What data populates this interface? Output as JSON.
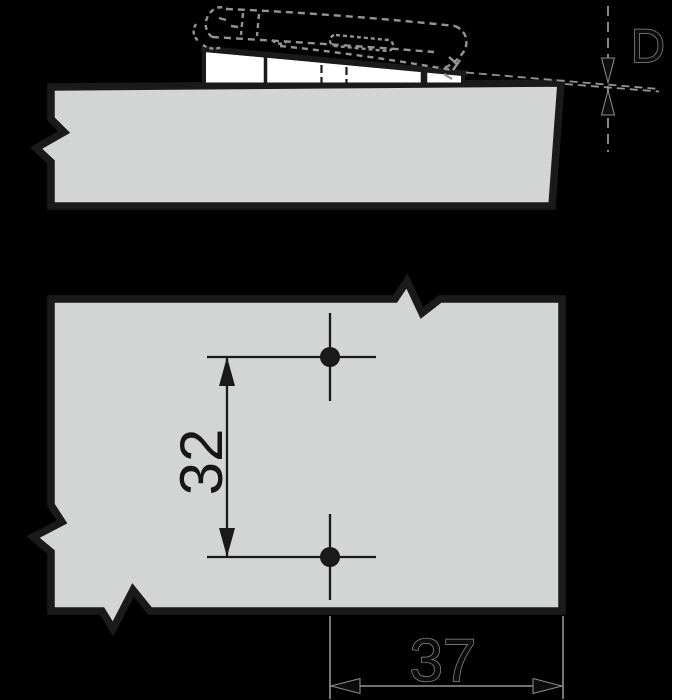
{
  "colors": {
    "background": "#000000",
    "right_margin_strip": "#ffffff",
    "panel_fill": "#d3d5d4",
    "wedge_fill": "#ffffff",
    "outline": "#1a1a1a",
    "ghost_line": "#949494"
  },
  "side_view": {
    "dimension_gap_label": "D"
  },
  "plan_view": {
    "dimension_hole_spacing_label": "32",
    "dimension_edge_distance_label": "37"
  }
}
